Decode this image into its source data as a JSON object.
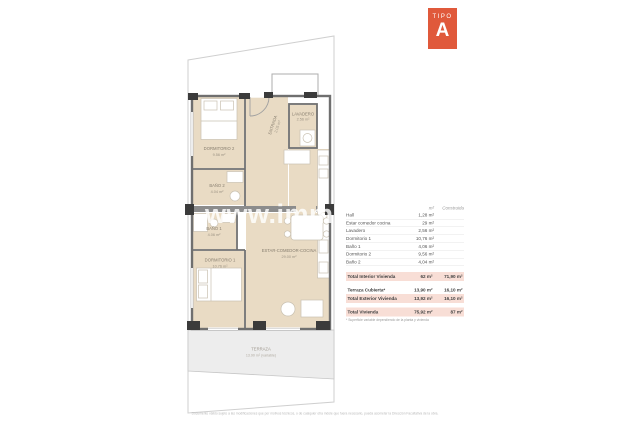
{
  "badge": {
    "label": "TIPO",
    "letter": "A"
  },
  "colors": {
    "accent_orange": "#e0593b",
    "room_beige": "#e9dbc4",
    "highlight_pink": "#f8ded6",
    "wall_gray": "#757575"
  },
  "plan": {
    "watermark": "www.immo",
    "rooms": [
      {
        "name": "DORMITORIO 2",
        "area": "9.56 m²"
      },
      {
        "name": "ENTRADA",
        "area": "2.05 m²"
      },
      {
        "name": "LAVADERO",
        "area": "2.56 m²"
      },
      {
        "name": "BAÑO 2",
        "area": "4.04 m²"
      },
      {
        "name": "BAÑO 1",
        "area": "4.06 m²"
      },
      {
        "name": "DORMITORIO 1",
        "area": "10.76 m²"
      },
      {
        "name": "ESTAR-COMEDOR-COCINA",
        "area": "29.00 m²"
      },
      {
        "name": "TERRAZA",
        "area": "13.90 m² (variable)"
      }
    ]
  },
  "table": {
    "headers": {
      "util": "m²",
      "construida": "Construida"
    },
    "rows": [
      {
        "label": "Hall",
        "util": "1,28 m²"
      },
      {
        "label": "Estar comedor cocina",
        "util": "29 m²"
      },
      {
        "label": "Lavadero",
        "util": "2,56 m²"
      },
      {
        "label": "Dormitorio 1",
        "util": "10,76 m²"
      },
      {
        "label": "Baño 1",
        "util": "4,06 m²"
      },
      {
        "label": "Dormitorio 2",
        "util": "9,56 m²"
      },
      {
        "label": "Baño 2",
        "util": "4,04 m²"
      }
    ],
    "totals": [
      {
        "label": "Total Interior Vivienda",
        "util": "62 m²",
        "construida": "71,90 m²"
      },
      {
        "label": "Terraza Cubierta*",
        "util": "13,90 m²",
        "construida": "16,10 m²"
      },
      {
        "label": "Total Exterior Vivienda",
        "util": "13,92 m²",
        "construida": "16,10 m²"
      },
      {
        "label": "Total Vivienda",
        "util": "75,92 m²",
        "construida": "87 m²"
      }
    ],
    "footnote": "* Superficie variable dependiendo de la planta y vivienda"
  },
  "footer": {
    "disclaimer": "Documento válido sujeto a las modificaciones que por motivos técnicos, o de cualquier otra índole que fuera necesario, pueda acometer la Dirección Facultativa de la obra."
  }
}
